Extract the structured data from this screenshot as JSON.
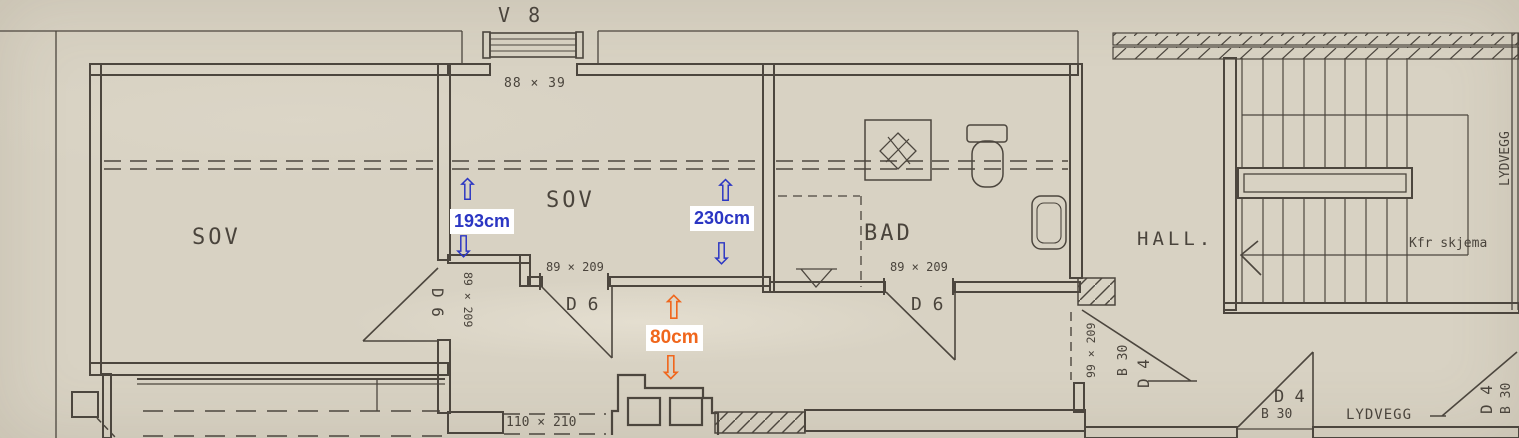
{
  "annotations": {
    "arrow_up": "⇧",
    "arrow_down": "⇩",
    "color_blue": "#2b36c3",
    "color_orange": "#f0661c",
    "measurements": {
      "left": "193cm",
      "middle": "230cm",
      "opening": "80cm"
    }
  },
  "plan": {
    "window_label": "V 8",
    "window_dim": "88 × 39",
    "room_sov_left": "SOV",
    "room_sov_mid": "SOV",
    "room_bad": "BAD",
    "room_hall": "HALL.",
    "note_kfr": "Kfr skjema",
    "lydvegg_vertical": "LYDVEGG",
    "lydvegg_horizontal": "LYDVEGG",
    "door_d6_left": "D 6",
    "door_d6_mid": "D 6",
    "door_d6_bad": "D 6",
    "dim_left_door": "89 × 209",
    "dim_mid_door": "89 × 209",
    "dim_bad_door": "89 × 209",
    "dim_hall_door": "99 × 209",
    "dim_lower_door": "110 × 210",
    "door_b30_hall": "B 30",
    "door_d4_hall": "D 4",
    "door_b30_mid": "B 30",
    "door_d4_mid": "D 4",
    "door_b30_right": "B 30",
    "door_d4_right": "D 4"
  }
}
